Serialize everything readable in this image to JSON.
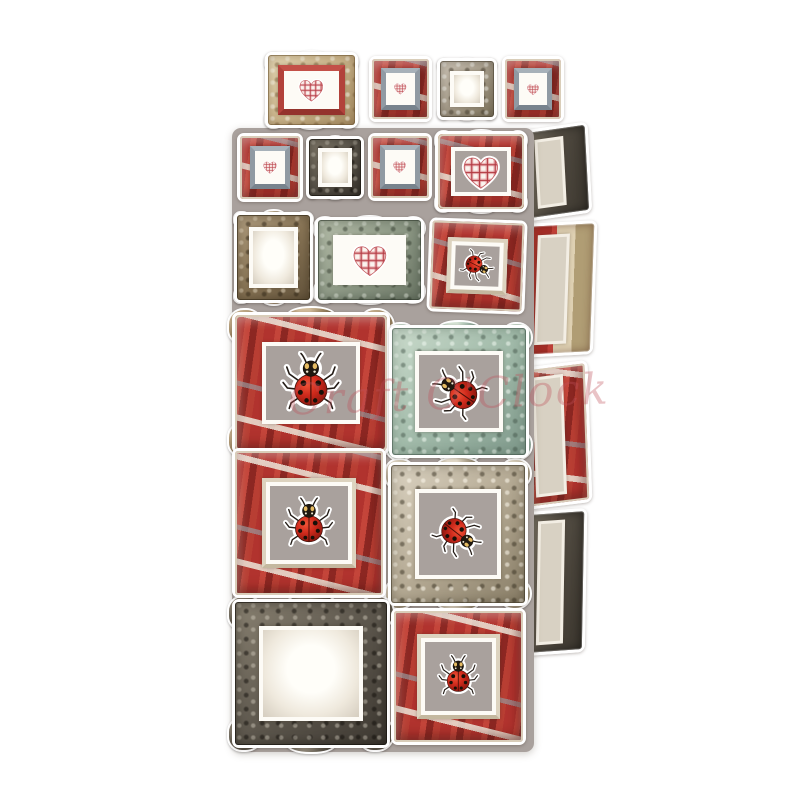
{
  "watermark": {
    "text": "Craft O'Clock",
    "color": "#c0525c",
    "opacity": 0.34
  },
  "background_color": "#ffffff",
  "palette": {
    "sheetc": "#a9a19d",
    "frame_red": "#b1332e",
    "frame_red_dark": "#8c2722",
    "frame_gold": "#cfb98f",
    "frame_silver": "#aaa08e",
    "frame_dark": "#5d574d",
    "frame_bronze": "#8a7657",
    "frame_teal": "#a3bcab",
    "frame_sage": "#8f9a87",
    "mat_white": "#fdfbf6",
    "heart_plaid_red": "#b23a42",
    "ladybug_red": "#cf2a1c",
    "ladybug_black": "#181008"
  },
  "sheet": {
    "name": "die-cut-sheet",
    "x": 232,
    "y": 128,
    "w": 302,
    "h": 624,
    "color": "#a9a19d",
    "radius": 9
  },
  "elements": [
    {
      "name": "frame-heart-gold-ornate",
      "type": "gold-ornate",
      "ornate": true,
      "content": "heart",
      "center": "white",
      "lip": "red",
      "x": 265,
      "y": 52,
      "w": 93,
      "h": 76,
      "bp": 12,
      "cs": 62
    },
    {
      "name": "frame-heart-red-top-1",
      "type": "red-rustic",
      "ornate": false,
      "content": "heart",
      "center": "white",
      "lip": "gray",
      "x": 369,
      "y": 56,
      "w": 63,
      "h": 66,
      "bp": 16,
      "cs": 70
    },
    {
      "name": "frame-empty-silver-top",
      "type": "silver-ornate",
      "ornate": true,
      "content": "blank",
      "center": "blankw",
      "lip": null,
      "x": 437,
      "y": 58,
      "w": 60,
      "h": 62,
      "bp": 18,
      "cs": 0
    },
    {
      "name": "frame-heart-red-top-2",
      "type": "red-rustic",
      "ornate": false,
      "content": "heart",
      "center": "white",
      "lip": "gray",
      "x": 502,
      "y": 56,
      "w": 62,
      "h": 66,
      "bp": 16,
      "cs": 70
    },
    {
      "name": "frame-heart-red-a1",
      "type": "red-rustic",
      "ornate": false,
      "content": "heart",
      "center": "white",
      "lip": "gray",
      "x": 237,
      "y": 133,
      "w": 66,
      "h": 69,
      "bp": 16,
      "cs": 70
    },
    {
      "name": "frame-empty-dark-a2",
      "type": "dark-ornate",
      "ornate": true,
      "content": "blank",
      "center": "blankw",
      "lip": null,
      "x": 306,
      "y": 136,
      "w": 58,
      "h": 63,
      "bp": 18,
      "cs": 0
    },
    {
      "name": "frame-heart-red-a3",
      "type": "red-rustic",
      "ornate": false,
      "content": "heart",
      "center": "white",
      "lip": "gray",
      "x": 368,
      "y": 133,
      "w": 64,
      "h": 68,
      "bp": 16,
      "cs": 70
    },
    {
      "name": "frame-heart-red-large",
      "type": "red-ornate",
      "ornate": true,
      "content": "heart",
      "center": "gray",
      "lip": null,
      "x": 435,
      "y": 131,
      "w": 92,
      "h": 81,
      "bp": 15,
      "cs": 80
    },
    {
      "name": "frame-empty-bronze",
      "type": "bronze-ornate",
      "ornate": true,
      "content": "blank",
      "center": "blankw",
      "lip": null,
      "x": 234,
      "y": 212,
      "w": 79,
      "h": 91,
      "bp": 17,
      "cs": 0
    },
    {
      "name": "frame-heart-sage",
      "type": "sage-ornate",
      "ornate": true,
      "content": "heart",
      "center": "white",
      "lip": null,
      "x": 315,
      "y": 217,
      "w": 109,
      "h": 86,
      "bp": 15,
      "cs": 62
    },
    {
      "name": "frame-ladybug-red-b3",
      "type": "red-rustic",
      "ornate": false,
      "content": "ladybug",
      "center": "gray",
      "lip": "cream",
      "x": 428,
      "y": 219,
      "w": 98,
      "h": 94,
      "bp": 17,
      "cs": 72,
      "rot": 2,
      "crot": 115
    },
    {
      "name": "frame-ladybug-red-ornate",
      "type": "red-ornate",
      "ornate": true,
      "content": "ladybug",
      "center": "gray",
      "lip": null,
      "x": 232,
      "y": 312,
      "w": 158,
      "h": 142,
      "bp": 17.5,
      "cs": 68
    },
    {
      "name": "frame-ladybug-teal",
      "type": "teal-ornate",
      "ornate": true,
      "content": "ladybug",
      "center": "gray",
      "lip": null,
      "x": 389,
      "y": 325,
      "w": 140,
      "h": 133,
      "bp": 17,
      "cs": 66,
      "crot": -55
    },
    {
      "name": "frame-ladybug-red-wood",
      "type": "red-rustic",
      "ornate": false,
      "content": "ladybug",
      "center": "gray",
      "lip": "cream",
      "x": 232,
      "y": 448,
      "w": 154,
      "h": 150,
      "bp": 18,
      "cs": 66
    },
    {
      "name": "frame-ladybug-baroque",
      "type": "silver-baroque",
      "ornate": true,
      "content": "ladybug",
      "center": "gray",
      "lip": null,
      "x": 388,
      "y": 462,
      "w": 140,
      "h": 144,
      "bp": 18,
      "cs": 62,
      "crot": 128
    },
    {
      "name": "frame-empty-dark-large",
      "type": "dark-ornate",
      "ornate": true,
      "content": "blank",
      "center": "blankw",
      "lip": null,
      "x": 232,
      "y": 599,
      "w": 158,
      "h": 149,
      "bp": 16,
      "cs": 0
    },
    {
      "name": "frame-ladybug-red-bottom",
      "type": "red-rustic",
      "ornate": false,
      "content": "ladybug",
      "center": "gray",
      "lip": "cream",
      "x": 391,
      "y": 608,
      "w": 135,
      "h": 137,
      "bp": 18,
      "cs": 64
    },
    {
      "name": "cut-frame-side-dark-1",
      "type": "dark-side side",
      "ornate": false,
      "content": "none",
      "center": "gray",
      "lip": null,
      "x": 524,
      "y": 126,
      "w": 66,
      "h": 91,
      "bp": 0,
      "cs": 0,
      "rot": -3
    },
    {
      "name": "cut-frame-side-redcream",
      "type": "redcream-side side",
      "ornate": false,
      "content": "none",
      "center": "gray",
      "lip": null,
      "x": 523,
      "y": 222,
      "w": 72,
      "h": 134,
      "bp": 0,
      "cs": 0,
      "rot": 2
    },
    {
      "name": "cut-frame-side-red",
      "type": "red-side side",
      "ornate": false,
      "content": "none",
      "center": "gray",
      "lip": null,
      "x": 522,
      "y": 364,
      "w": 68,
      "h": 142,
      "bp": 0,
      "cs": 0,
      "rot": -2
    },
    {
      "name": "cut-frame-side-dark-2",
      "type": "dark-side side",
      "ornate": false,
      "content": "none",
      "center": "gray",
      "lip": null,
      "x": 526,
      "y": 510,
      "w": 60,
      "h": 144,
      "bp": 0,
      "cs": 0,
      "rot": 1
    }
  ]
}
